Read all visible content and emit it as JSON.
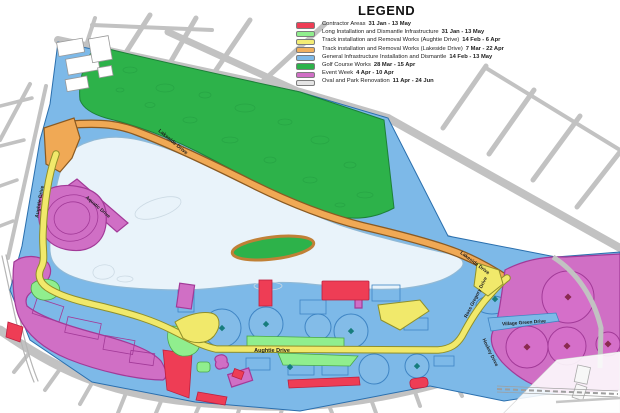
{
  "legend": {
    "title": "LEGEND",
    "items": [
      {
        "label": "Contractor Areas",
        "dates": "31 Jan - 13 May",
        "color": "#ee3d55"
      },
      {
        "label": "Long Installation and Dismantle Infrastructure",
        "dates": "31 Jan - 13 May",
        "color": "#90ee8e"
      },
      {
        "label": "Track installation and Removal Works (Aughtie Drive)",
        "dates": "14 Feb - 6 Apr",
        "color": "#f3ec74"
      },
      {
        "label": "Track installation and Removal Works (Lakeside Drive)",
        "dates": "7 Mar - 22 Apr",
        "color": "#f1b05e"
      },
      {
        "label": "General Infrastructure Installation and Dismantle",
        "dates": "14 Feb - 13 May",
        "color": "#7db9e8"
      },
      {
        "label": "Golf Course Works",
        "dates": "28 Mar - 15 Apr",
        "color": "#2db24a"
      },
      {
        "label": "Event Week",
        "dates": "4 Apr - 10 Apr",
        "color": "#d06fc5"
      },
      {
        "label": "Oval and Park Renovation",
        "dates": "11 Apr - 24 Jun",
        "color": "#e4e4e4"
      }
    ]
  },
  "roads": {
    "lakeside_nw": "Lakeside Drive",
    "lakeside_e": "Lakeside Drive",
    "aughtie_w": "Aughtie Drive",
    "aughtie_s": "Aughtie Drive",
    "aquatic": "Aquatic Drive",
    "ross_gregory": "Ross Gregory Drive",
    "village_green": "Village Green Drive",
    "hockey": "Hockey Drive"
  },
  "colors": {
    "contractor": "#ee3d55",
    "long_installation": "#90ee8e",
    "track_aughtie": "#f1e96b",
    "track_lakeside": "#f0a955",
    "general_infrastructure": "#7db9e8",
    "golf_course": "#2db24a",
    "event_week": "#d06fc5",
    "oval_renovation": "#e4e4e4",
    "lake": "#e9f3fa",
    "streets": "#c2c2c2"
  }
}
